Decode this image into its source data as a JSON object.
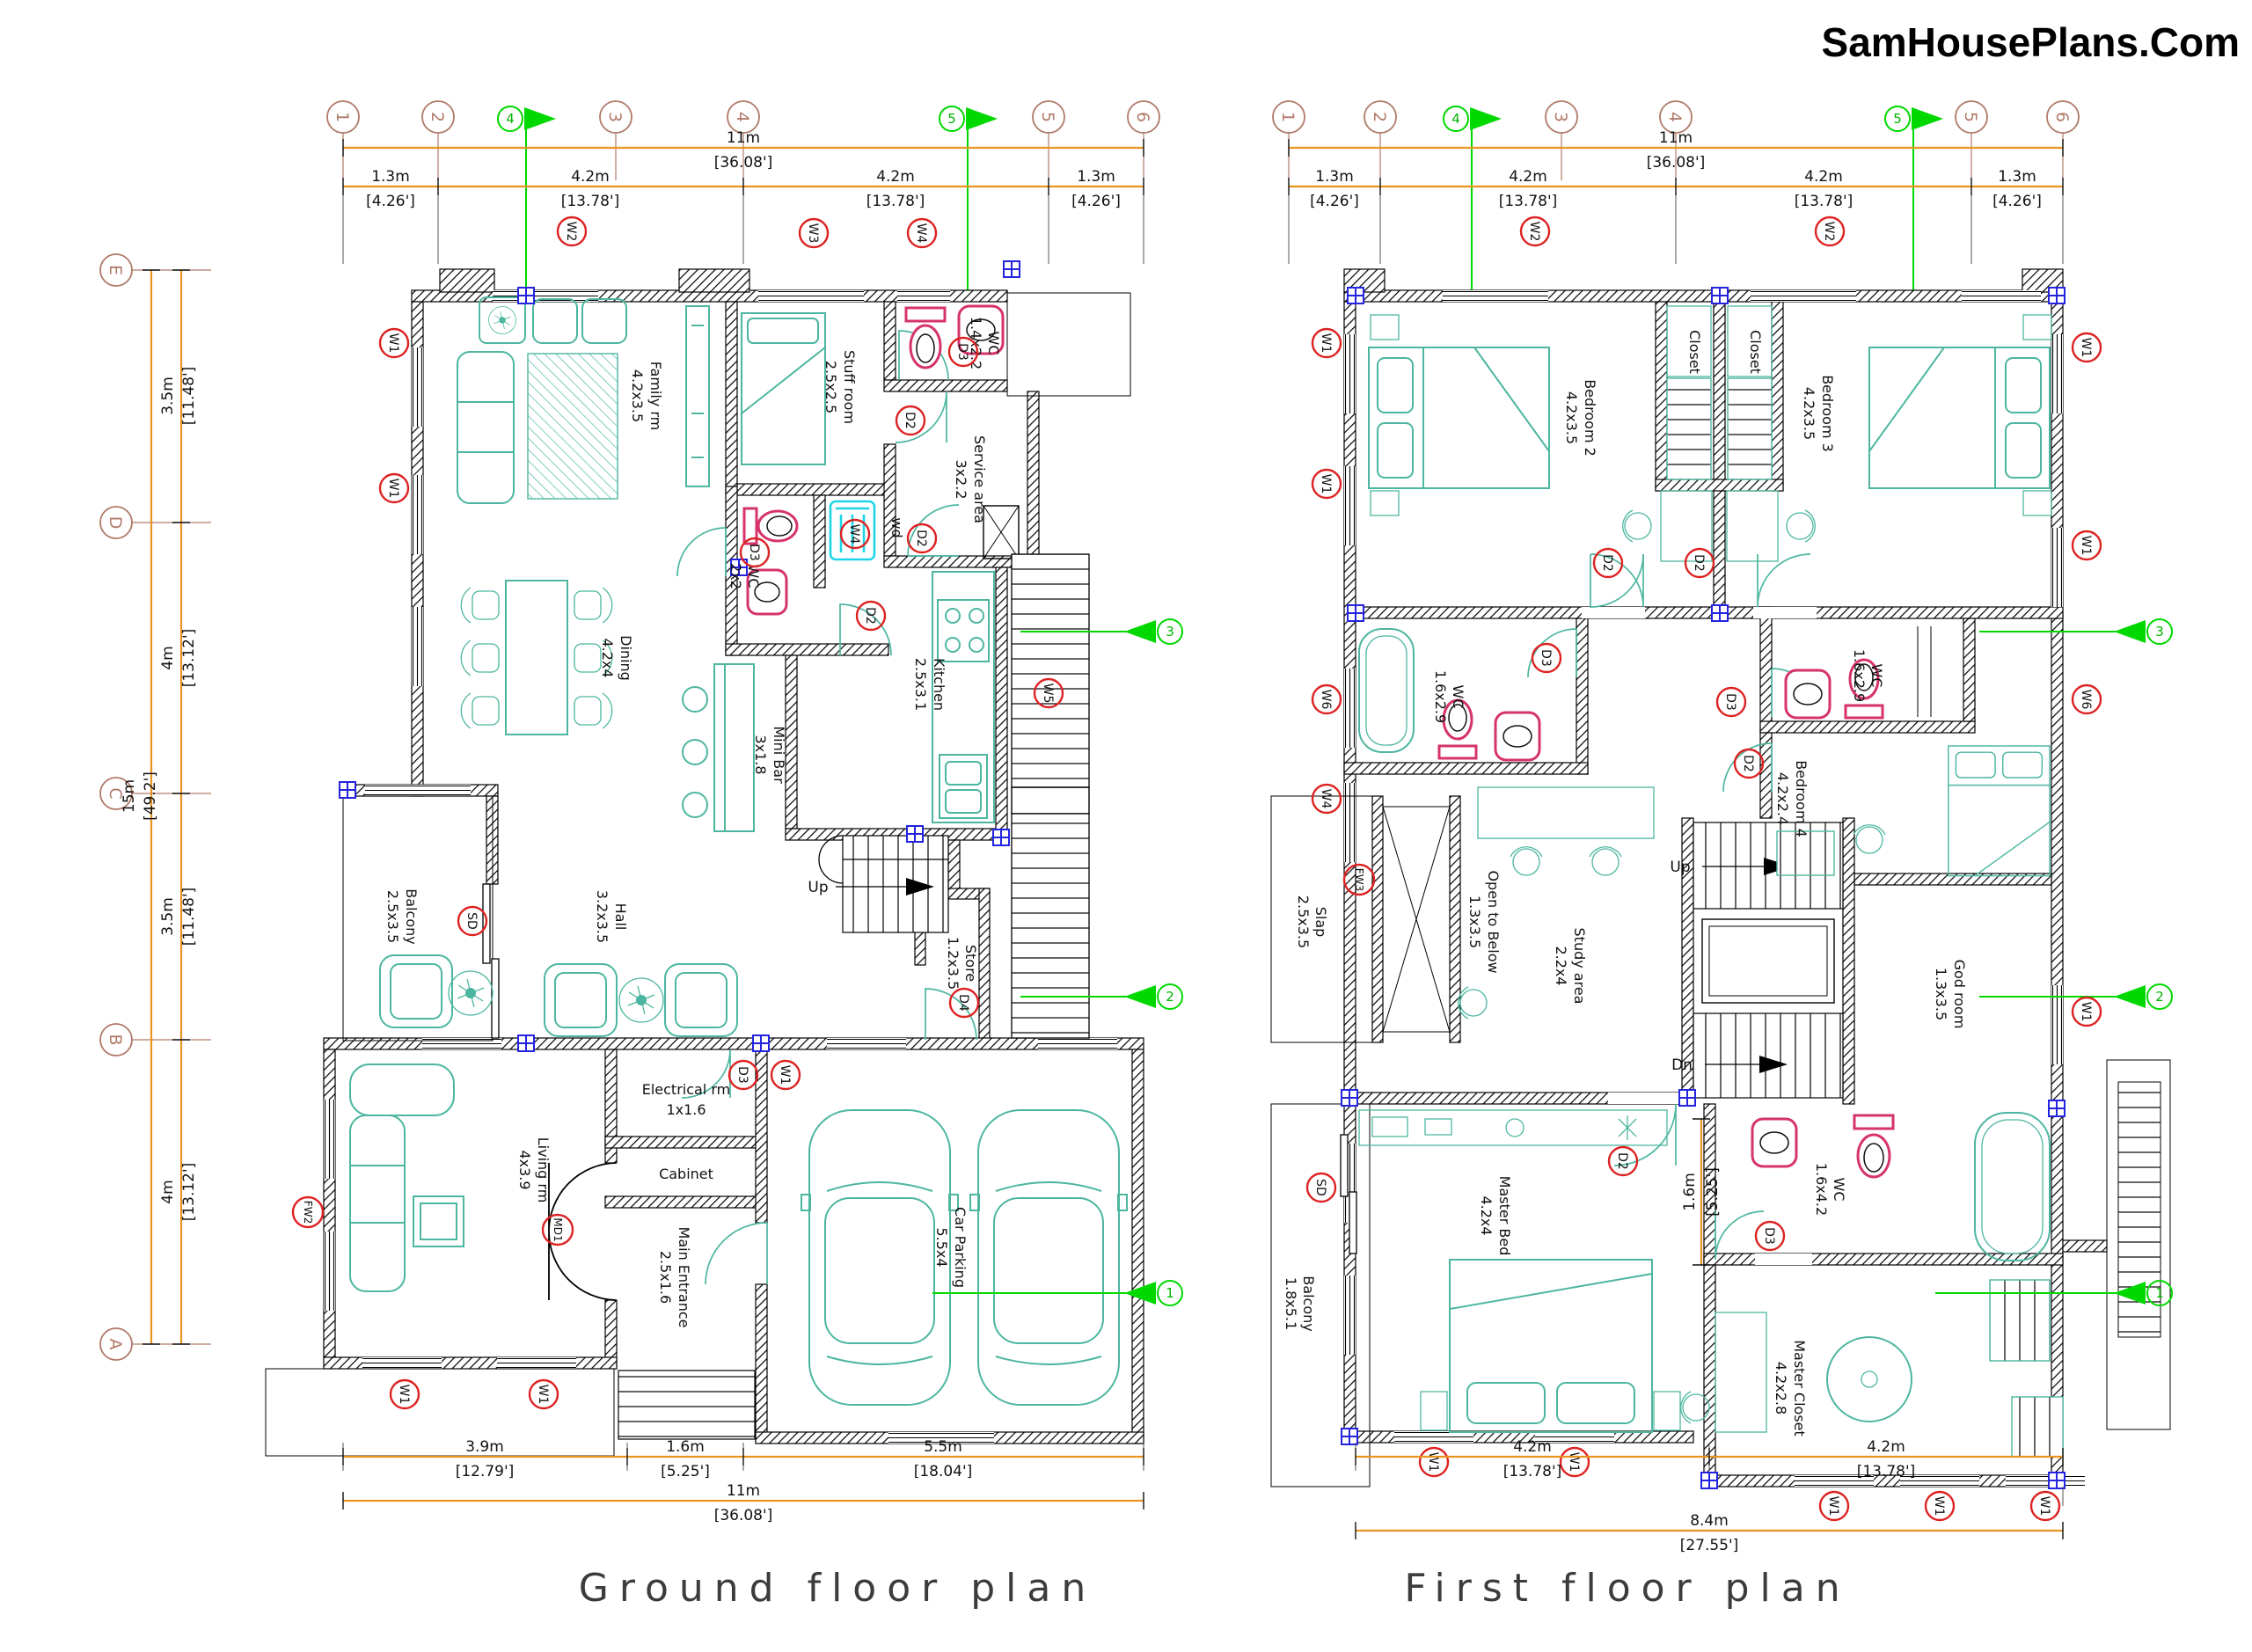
{
  "site": {
    "brand": "SamHousePlans.Com"
  },
  "colors": {
    "wall": "#000000",
    "furniture": "#4db6a0",
    "fixture": "#d6336c",
    "appliance": "#1ed4e6",
    "dimension": "#e8941f",
    "grid_bubble": "#b07a68",
    "section_flag": "#00d800",
    "marker": "#dd2222",
    "junction": "#2323e0"
  },
  "grid": {
    "cols": [
      "1",
      "2",
      "3",
      "4",
      "5",
      "6"
    ],
    "rows": [
      "E",
      "D",
      "C",
      "B",
      "A"
    ],
    "flags": {
      "f1": "1",
      "f2": "2",
      "f3": "3",
      "f4": "4",
      "f5": "5"
    }
  },
  "dims": {
    "m11": "11m",
    "ft11": "[36.08']",
    "m13": "1.3m",
    "ft13": "[4.26']",
    "m42": "4.2m",
    "ft42": "[13.78']",
    "m35": "3.5m",
    "ft35": "[11.48']",
    "m4": "4m",
    "ft4": "[13.12']",
    "m15": "15m",
    "ft15": "[49.2']",
    "m39": "3.9m",
    "ft39": "[12.79']",
    "m16": "1.6m",
    "ft16": "[5.25']",
    "m55": "5.5m",
    "ft55": "[18.04']",
    "m84": "8.4m",
    "ft84": "[27.55']"
  },
  "markers": {
    "w1": "W1",
    "w2": "W2",
    "w3": "W3",
    "w4": "W4",
    "w5": "W5",
    "w6": "W6",
    "d2": "D2",
    "d3": "D3",
    "d4": "D4",
    "sd": "SD",
    "fw2": "FW2",
    "fw3": "FW3",
    "md1": "MD1"
  },
  "ground": {
    "title": "Ground floor plan",
    "labels": {
      "up": "Up"
    },
    "rooms": {
      "family": {
        "name": "Family rm",
        "size": "4.2x3.5"
      },
      "stuff": {
        "name": "Stuff room",
        "size": "2.5x2.5"
      },
      "wc1": {
        "name": "WC",
        "size": "1.4x2.2"
      },
      "service": {
        "name": "Service area",
        "size": "3x2.2"
      },
      "wc2": {
        "name": "WC",
        "size": "2x2"
      },
      "wd": {
        "name": "wd"
      },
      "dining": {
        "name": "Dining",
        "size": "4.2x4"
      },
      "minibar": {
        "name": "Mini Bar",
        "size": "3x1.8"
      },
      "kitchen": {
        "name": "Kitchen",
        "size": "2.5x3.1"
      },
      "hall": {
        "name": "Hall",
        "size": "3.2x3.5"
      },
      "balcony": {
        "name": "Balcony",
        "size": "2.5x3.5"
      },
      "store": {
        "name": "Store",
        "size": "1.2x3.5"
      },
      "electrical": {
        "name": "Electrical rm",
        "size": "1x1.6"
      },
      "cabinet": {
        "name": "Cabinet"
      },
      "living": {
        "name": "Living rm",
        "size": "4x3.9"
      },
      "entrance": {
        "name": "Main Entrance",
        "size": "2.5x1.6"
      },
      "parking": {
        "name": "Car Parking",
        "size": "5.5x4"
      }
    }
  },
  "first": {
    "title": "First floor plan",
    "labels": {
      "up": "Up",
      "dn": "Dn"
    },
    "rooms": {
      "bed2": {
        "name": "Bedroom 2",
        "size": "4.2x3.5"
      },
      "closet": {
        "name": "Closet"
      },
      "bed3": {
        "name": "Bedroom 3",
        "size": "4.2x3.5"
      },
      "wcl": {
        "name": "WC",
        "size": "1.6x2.9"
      },
      "wcr": {
        "name": "WC",
        "size": "1.6x2.9"
      },
      "study": {
        "name": "Study area",
        "size": "2.2x4"
      },
      "bed4": {
        "name": "Bedroom 4",
        "size": "4.2x2.4"
      },
      "slap": {
        "name": "Slap",
        "size": "2.5x3.5"
      },
      "open": {
        "name": "Open to Below",
        "size": "1.3x3.5"
      },
      "god": {
        "name": "God room",
        "size": "1.3x3.5"
      },
      "master": {
        "name": "Master Bed",
        "size": "4.2x4"
      },
      "wcm": {
        "name": "WC",
        "size": "1.6x4.2"
      },
      "balcony": {
        "name": "Balcony",
        "size": "1.8x5.1"
      },
      "closetm": {
        "name": "Master Closet",
        "size": "4.2x2.8"
      }
    }
  }
}
